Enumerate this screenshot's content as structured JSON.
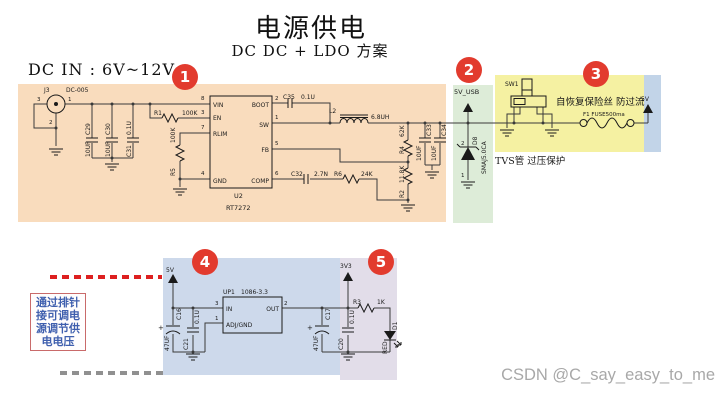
{
  "page": {
    "title": "电源供电",
    "subtitle": "DC DC + LDO 方案",
    "dc_in": "DC IN : 6V~12V",
    "watermark": "CSDN @C_say_easy_to_me"
  },
  "badges": [
    "1",
    "2",
    "3",
    "4",
    "5"
  ],
  "notes": {
    "tvs": "TVS管 过压保护",
    "fuse": "自恢复保险丝 防过流",
    "header_lines": [
      "通过排针",
      "接可调电",
      "源调节供",
      "电电压"
    ]
  },
  "colors": {
    "region1": "#f9dcbd",
    "region2": "#ddecd8",
    "region3": "#f5f1a2",
    "region4": "#cdd9eb",
    "region5": "#e2dde9",
    "strip5v": "#c2d4e8",
    "badge": "#e23b2e",
    "wire": "#3a3a3a",
    "dash_red": "#dd2020",
    "dash_gray": "#909090",
    "note_text": "#3f5fae",
    "note_border": "#c96a6a",
    "watermark": "#a8a8a8"
  },
  "sch": {
    "j3_ref": "J3",
    "j3_part": "DC-005",
    "j3_p1": "1",
    "j3_p2": "2",
    "j3_p3": "3",
    "c29_ref": "C29",
    "c29_val": "10UF",
    "c30_ref": "C30",
    "c30_val": "10UF",
    "c31_ref": "C31",
    "c31_val": "0.1U",
    "r1_ref": "R1",
    "r1_val": "100K",
    "r5_ref": "R5",
    "r5_val": "100K",
    "u2_ref": "U2",
    "u2_part": "RT7272",
    "pin_vin": "VIN",
    "pin_vin_n": "8",
    "pin_en": "EN",
    "pin_en_n": "3",
    "pin_rlim": "RLIM",
    "pin_rlim_n": "7",
    "pin_gnd": "GND",
    "pin_gnd_n": "4",
    "pin_boot": "BOOT",
    "pin_boot_n": "2",
    "pin_sw": "SW",
    "pin_sw_n": "1",
    "pin_fb": "FB",
    "pin_fb_n": "5",
    "pin_comp": "COMP",
    "pin_comp_n": "6",
    "c35_ref": "C35",
    "c35_val": "0.1U",
    "l2_ref": "L2",
    "l2_val": "6.8UH",
    "c32_ref": "C32",
    "c32_val": "2.7N",
    "r6_ref": "R6",
    "r6_val": "24K",
    "r4_ref": "R4",
    "r4_val": "62K",
    "r2_ref": "R2",
    "r2_val": "11.8K",
    "c33_ref": "C33",
    "c33_val": "10UF",
    "c34_ref": "C34",
    "c34_val": "10UF",
    "net_5v_usb": "5V_USB",
    "d8_ref": "D8",
    "d8_part": "SMAJ5.0CA",
    "d8_p1": "1",
    "d8_p2": "2",
    "sw1_ref": "SW1",
    "f1_label": "F1  FUSE500ma",
    "net_5v_out": "5V",
    "net_5v_ldo": "5V",
    "net_3v3": "3V3",
    "c16_ref": "C16",
    "c16_val": "47UF",
    "c16_plus": "+",
    "c21_ref": "C21",
    "c21_val": "0.1U",
    "up1_ref": "UP1",
    "up1_part": "1086-3.3",
    "pin_in": "IN",
    "pin_in_n": "3",
    "pin_out": "OUT",
    "pin_out_n": "2",
    "pin_adj": "ADJ/GND",
    "pin_adj_n": "1",
    "c17_ref": "C17",
    "c17_val": "47UF",
    "c17_plus": "+",
    "c20_ref": "C20",
    "c20_val": "0.1U",
    "r3_ref": "R3",
    "r3_val": "1K",
    "d1_ref": "D1",
    "d1_val": "RED"
  }
}
